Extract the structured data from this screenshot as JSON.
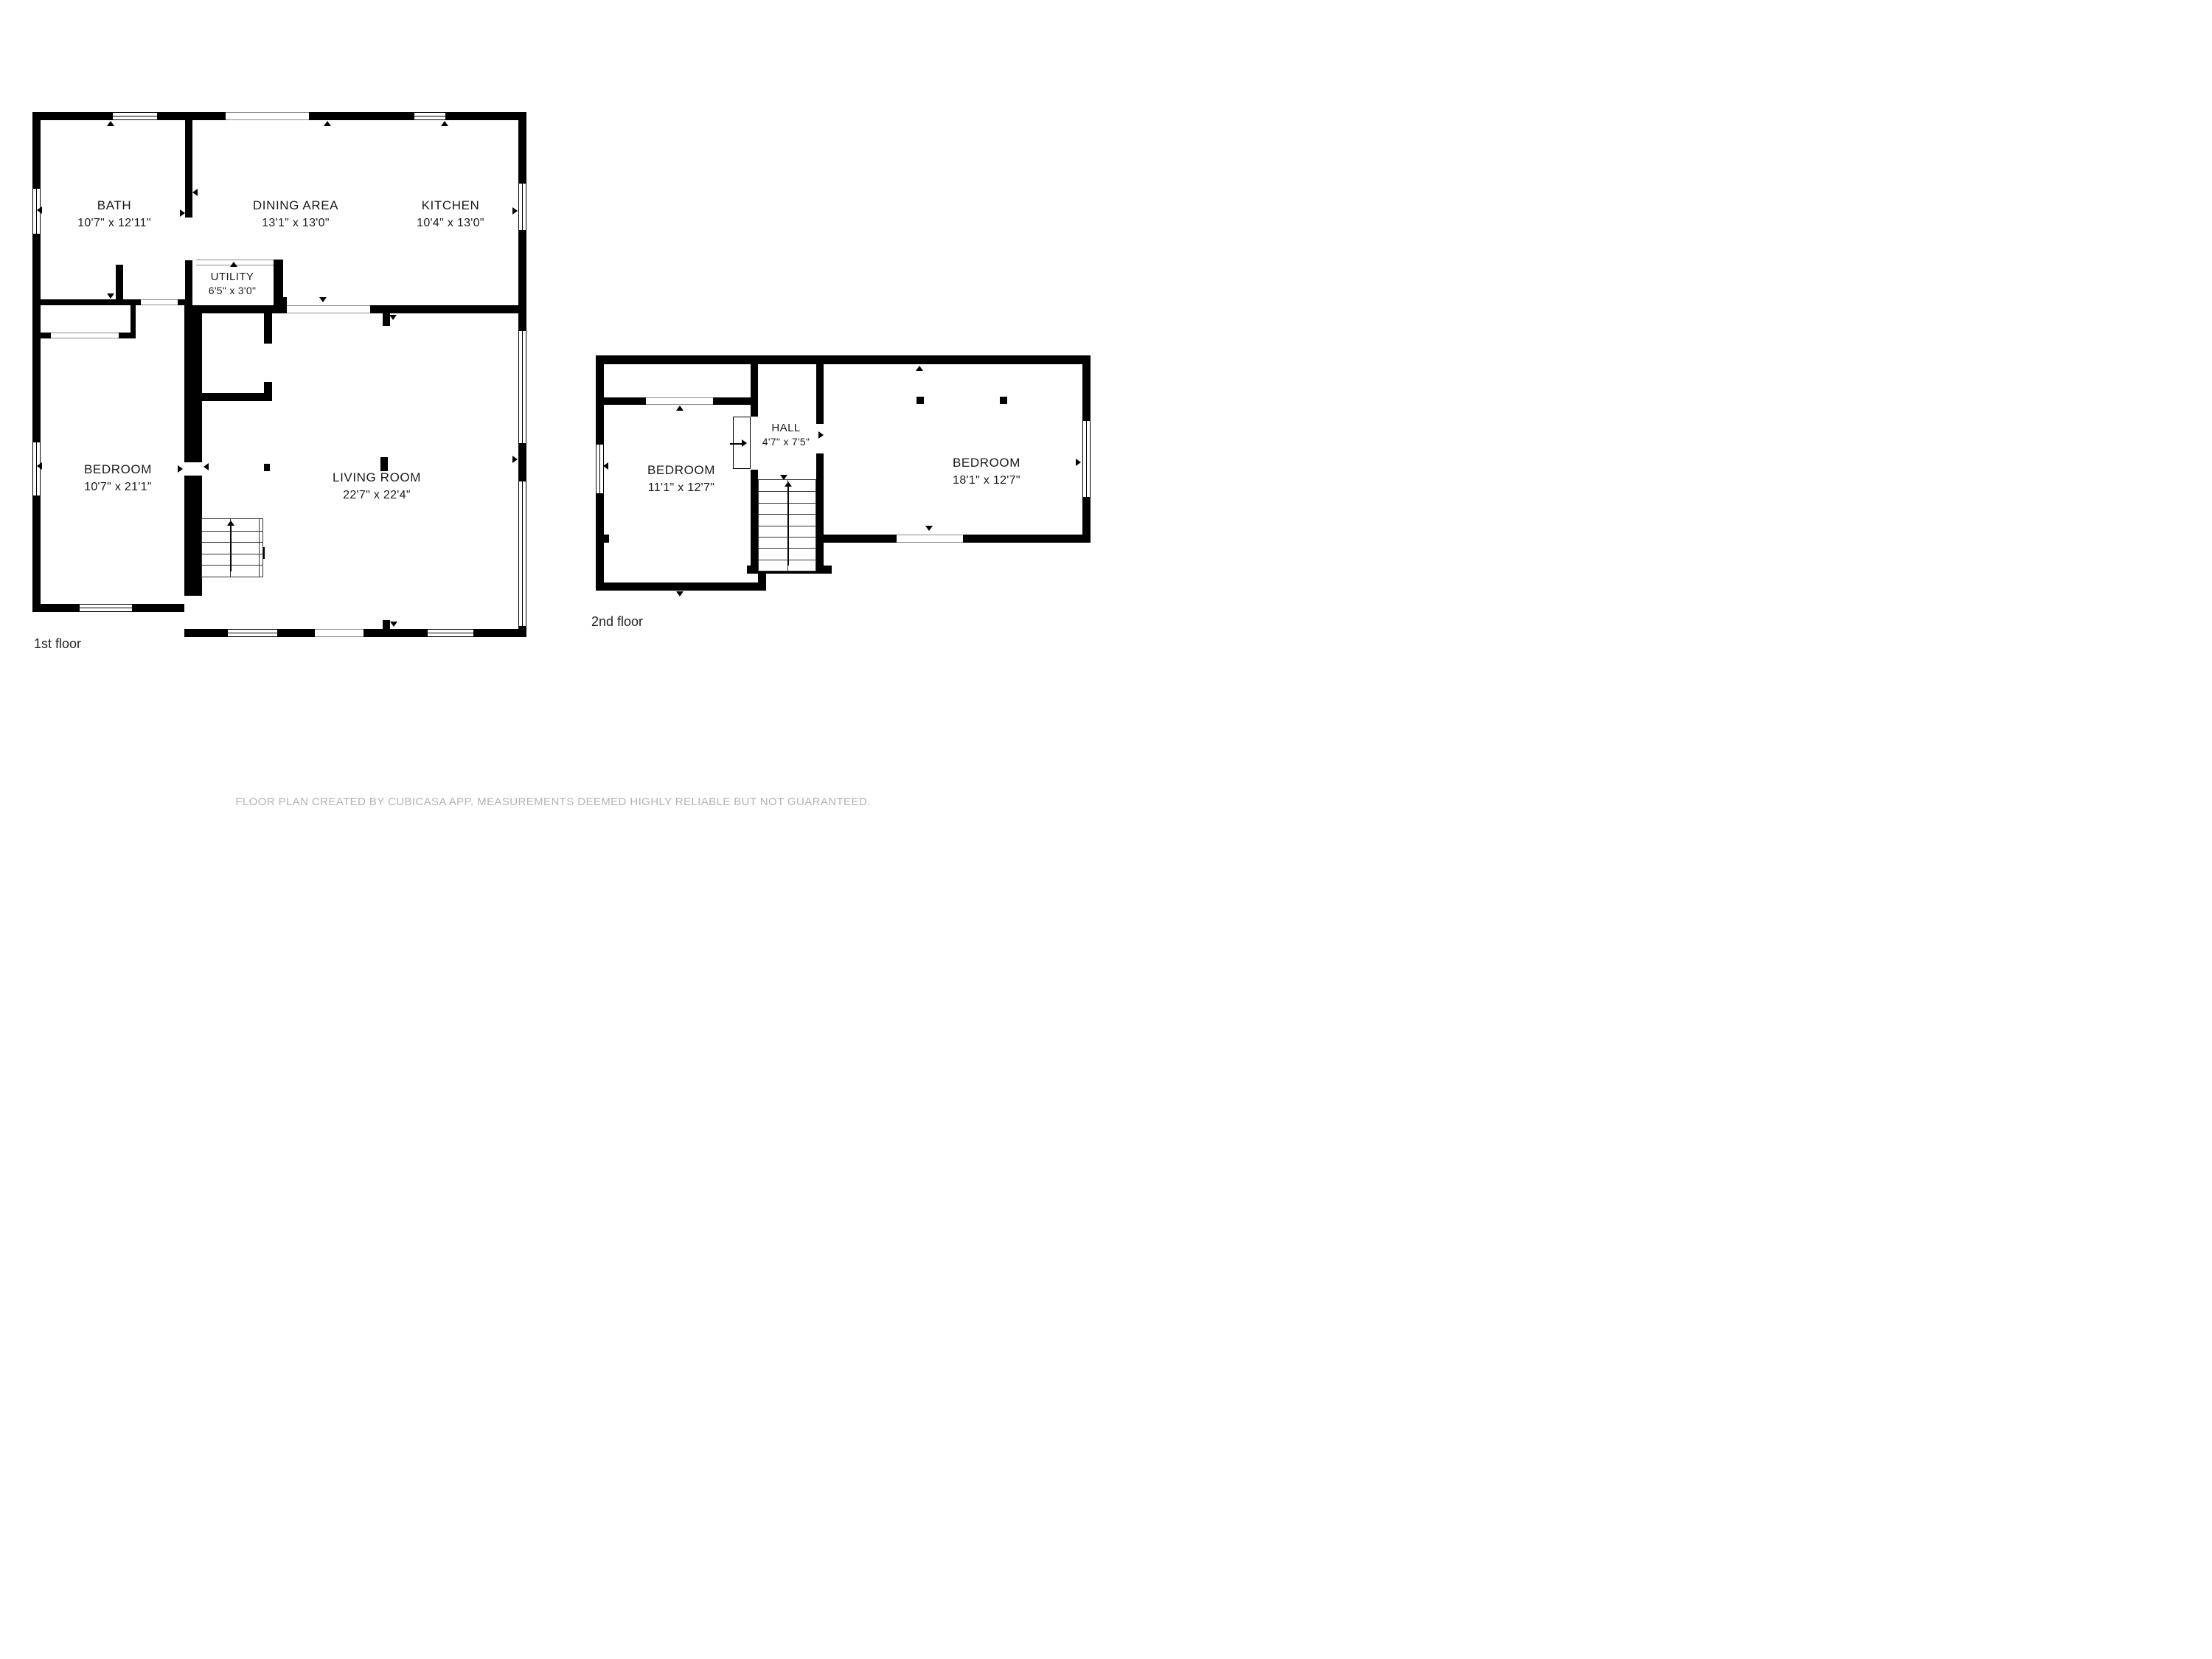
{
  "floors": [
    {
      "label": "1st floor",
      "rooms": [
        {
          "name": "BATH",
          "dims": "10'7\" x 12'11\""
        },
        {
          "name": "DINING AREA",
          "dims": "13'1\" x 13'0\""
        },
        {
          "name": "KITCHEN",
          "dims": "10'4\" x 13'0\""
        },
        {
          "name": "UTILITY",
          "dims": "6'5\" x 3'0\""
        },
        {
          "name": "BEDROOM",
          "dims": "10'7\" x 21'1\""
        },
        {
          "name": "LIVING ROOM",
          "dims": "22'7\" x 22'4\""
        }
      ]
    },
    {
      "label": "2nd floor",
      "rooms": [
        {
          "name": "BEDROOM",
          "dims": "11'1\" x 12'7\""
        },
        {
          "name": "HALL",
          "dims": "4'7\" x 7'5\""
        },
        {
          "name": "BEDROOM",
          "dims": "18'1\" x 12'7\""
        }
      ]
    }
  ],
  "disclaimer": "FLOOR PLAN CREATED BY CUBICASA APP. MEASUREMENTS DEEMED HIGHLY RELIABLE BUT NOT GUARANTEED.",
  "colors": {
    "wall": "#000000",
    "background": "#ffffff",
    "disclaimer": "#b3b3b3",
    "text": "#1a1a1a"
  }
}
